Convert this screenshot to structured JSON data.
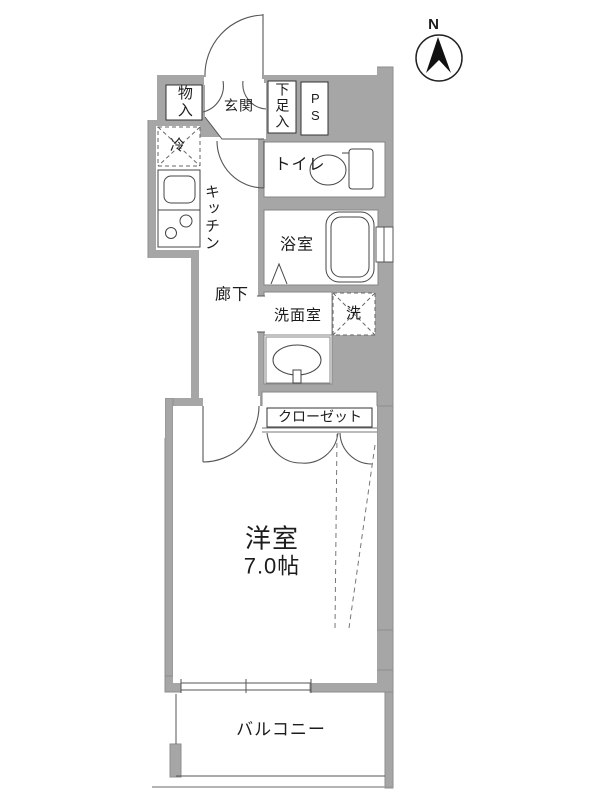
{
  "compass": {
    "north_label": "N"
  },
  "labels": {
    "storage": "物入",
    "entrance": "玄関",
    "shoe_cabinet": "下足入",
    "pipe_space": "PS",
    "refrigerator": "冷",
    "kitchen": "キッチン",
    "toilet": "トイレ",
    "bathroom": "浴室",
    "hallway": "廊下",
    "washroom": "洗面室",
    "washer": "洗",
    "closet": "クローゼット",
    "western_room": "洋室",
    "western_room_size": "7.0帖",
    "balcony": "バルコニー"
  },
  "colors": {
    "wall_fill": "#a6a6a6",
    "wall_edge": "#8e8e8e",
    "line": "#4a4a4a",
    "background": "#ffffff",
    "text": "#1c1c1c"
  }
}
